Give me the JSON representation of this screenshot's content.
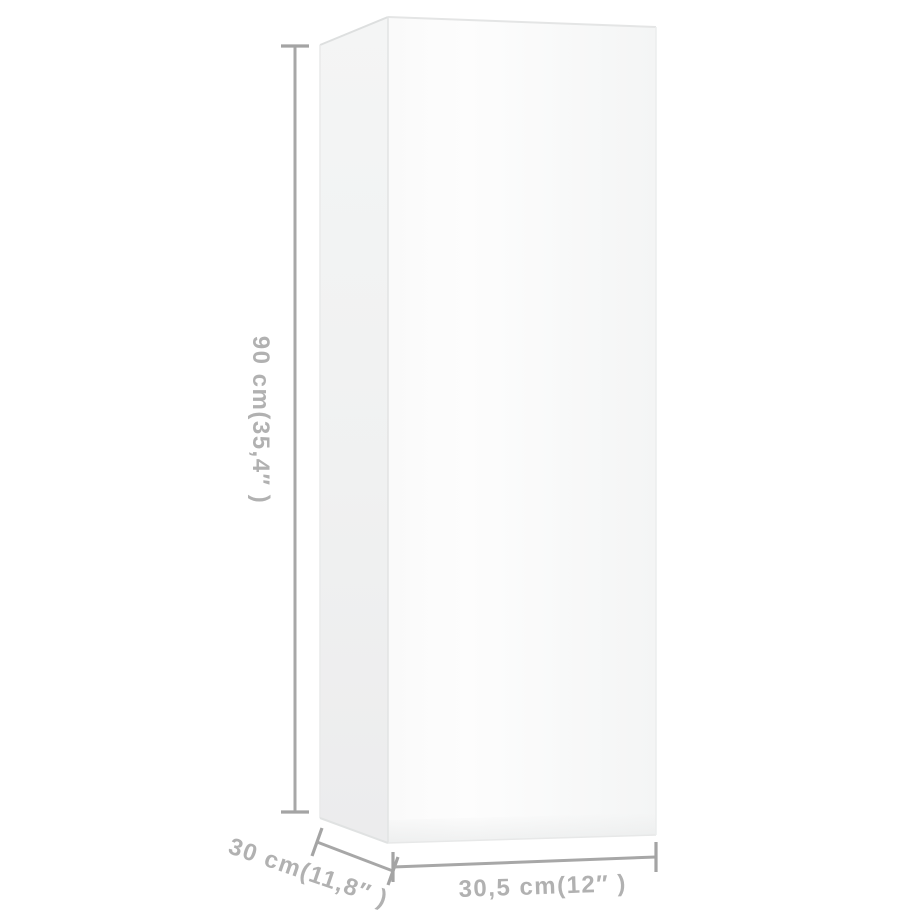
{
  "diagram": {
    "type": "product-dimension-diagram",
    "subject": "white wall cabinet shown in 3d perspective with measurement lines"
  },
  "dimensions": {
    "height": {
      "label": "90 cm(35,4″ )",
      "cm": "90",
      "inches": "35,4"
    },
    "depth": {
      "label": "30 cm(11,8″ )",
      "cm": "30",
      "inches": "11,8"
    },
    "width": {
      "label": "30,5 cm(12″ )",
      "cm": "30,5",
      "inches": "12"
    }
  },
  "colors": {
    "dimension_line": "#a7a7a7",
    "dimension_text": "#b1b1b1",
    "cabinet_front": "#f8f9f9",
    "cabinet_side": "#efefef",
    "background": "#ffffff"
  }
}
